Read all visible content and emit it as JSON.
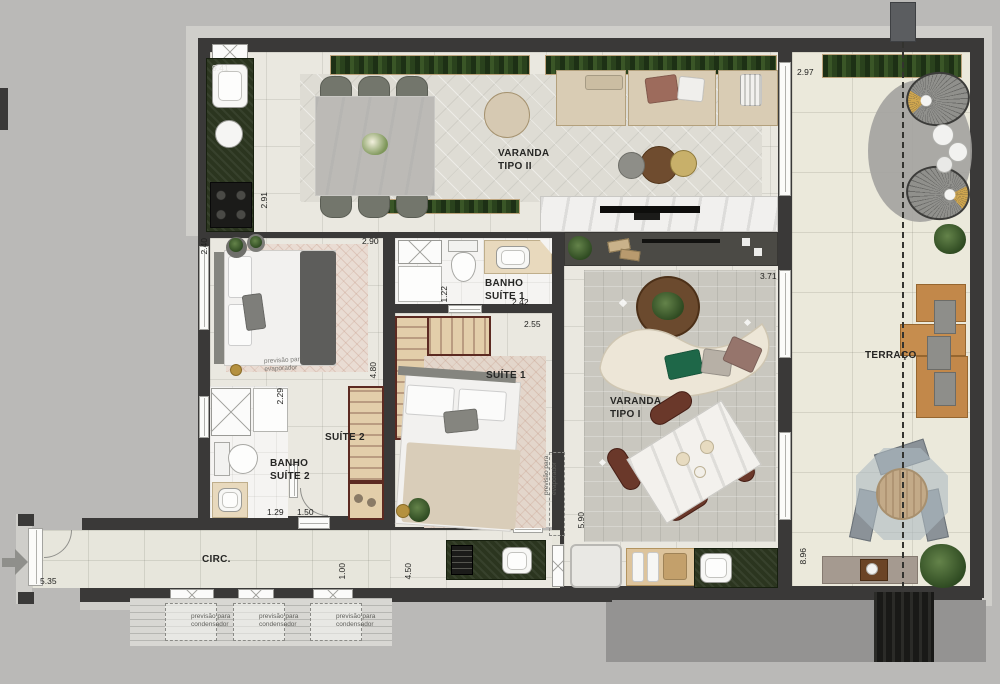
{
  "plan_title": "apartment floor plan",
  "rooms": {
    "varanda_tipo_2": {
      "line1": "VARANDA",
      "line2": "TIPO II"
    },
    "varanda_tipo_1": {
      "line1": "VARANDA",
      "line2": "TIPO I"
    },
    "banho_suite_1": {
      "line1": "BANHO",
      "line2": "SUÍTE 1"
    },
    "banho_suite_2": {
      "line1": "BANHO",
      "line2": "SUÍTE 2"
    },
    "suite_1": {
      "label": "SUÍTE 1"
    },
    "suite_2": {
      "label": "SUÍTE 2"
    },
    "terraco": {
      "label": "TERRAÇO"
    },
    "circ": {
      "label": "CIRC."
    }
  },
  "dimensions": {
    "kitchen_len": "9.41",
    "kitchen_w": "2.91",
    "terrace_top": "2.97",
    "suite2_top": "2.90",
    "suite2_left": "2.40",
    "suite2_len": "4.80",
    "banho2_len": "2.29",
    "banho2_w": "1.29",
    "suite2_door": "1.50",
    "banho1_w": "1.22",
    "banho1_len": "2.42",
    "suite1_top": "2.55",
    "living_top": "3.71",
    "circ_len": "5.35",
    "circ_w": "1.00",
    "hall_w": "4.50",
    "living_len": "5.90",
    "terrace_len": "8.96"
  },
  "annotations": {
    "previsao": "previsão para",
    "condensador": "condensador",
    "evaporador": "evaporador"
  },
  "colors": {
    "wall": "#3a3938",
    "counter_green": "#2b351f",
    "closet_wood": "#e3ceaa",
    "closet_border": "#5c2a21",
    "gold_accent": "#cfa64f",
    "chair_brown": "#6a382a"
  }
}
